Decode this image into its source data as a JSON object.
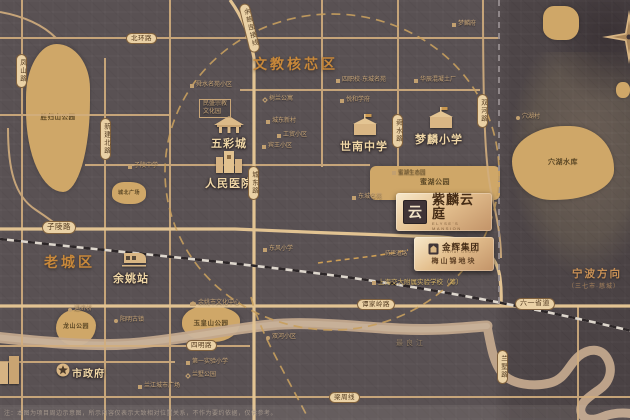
{
  "zones": {
    "edu_core": "文教核芯区",
    "old_town": "老城区",
    "ningbo_dir": "宁波方向",
    "ningbo_sub": "（三七市·慈城）"
  },
  "project": {
    "logo_glyph": "云",
    "name": "紫麟云庭",
    "name_en": "ELYSE'S MANSION",
    "developer": "金辉集团",
    "developer_en": "JINHUI GROUP",
    "plot": "梅山锦地块"
  },
  "colors": {
    "background": "#595153",
    "road": "#d2ae7e",
    "road_major": "#e2c392",
    "park": "#cfa768",
    "zone_title": "#c8883a",
    "poi_text": "#f0d7a6",
    "badge_gold": "#e4c08f",
    "river": "#c3a88d",
    "railway_dark": "#2c2628"
  },
  "disclaimer": "注：本图为项目周边示意图，所示内容仅表示大致相对位置关系，不作为要约依据，仅供参考。",
  "parks": [
    {
      "name": "shengguishan-park",
      "label": "胜归山公园",
      "x": 26,
      "y": 44,
      "w": 64,
      "h": 148,
      "r": "48% 52% 42% 58% / 36% 30% 62% 55%",
      "fs": 6.5
    },
    {
      "name": "north-plaza",
      "label": "城北广场",
      "x": 112,
      "y": 182,
      "w": 34,
      "h": 22,
      "r": "35% 45% 40% 45% / 45% 45% 40% 40%",
      "fs": 5
    },
    {
      "name": "longshan-park",
      "label": "龙山公园",
      "x": 56,
      "y": 310,
      "w": 40,
      "h": 36,
      "r": "45% 55% 50% 50% / 50% 42% 58% 50%",
      "fs": 6
    },
    {
      "name": "yuhuangshan-park",
      "label": "玉皇山公园",
      "x": 182,
      "y": 306,
      "w": 58,
      "h": 36,
      "r": "40% 50% 45% 55% / 45% 40% 55% 50%",
      "fs": 6.5
    },
    {
      "name": "mihu-park",
      "label": "蜜湖公园",
      "x": 370,
      "y": 166,
      "w": 130,
      "h": 34,
      "r": "6px",
      "fs": 7
    },
    {
      "name": "xuehu-reservoir",
      "label": "穴湖水库",
      "x": 512,
      "y": 126,
      "w": 102,
      "h": 74,
      "r": "55% 45% 60% 40% / 50% 60% 42% 55%",
      "fs": 7
    },
    {
      "name": "ne-green-block",
      "label": "",
      "x": 543,
      "y": 6,
      "w": 36,
      "h": 34,
      "r": "30% 40% 35% 40% / 35% 40% 40% 35%",
      "fs": 5
    },
    {
      "name": "ne-green-dot",
      "label": "",
      "x": 616,
      "y": 82,
      "w": 14,
      "h": 16,
      "r": "45%",
      "fs": 5
    }
  ],
  "pois": [
    {
      "name": "wucai-city",
      "label": "五彩城",
      "x": 211,
      "y": 135,
      "fs": 11,
      "icon": "pavilion",
      "ix": 211,
      "iy": 114
    },
    {
      "name": "peoples-hospital",
      "label": "人民医院",
      "x": 205,
      "y": 175,
      "fs": 11,
      "icon": "hospital",
      "ix": 215,
      "iy": 148
    },
    {
      "name": "shinan-middle-school",
      "label": "世南中学",
      "x": 340,
      "y": 138,
      "fs": 11,
      "icon": "school",
      "ix": 352,
      "iy": 114
    },
    {
      "name": "menglin-primary-school",
      "label": "梦麟小学",
      "x": 415,
      "y": 131,
      "fs": 11,
      "icon": "school",
      "ix": 428,
      "iy": 107
    },
    {
      "name": "yuyao-station",
      "label": "余姚站",
      "x": 113,
      "y": 270,
      "fs": 11,
      "icon": "train",
      "ix": 120,
      "iy": 252
    },
    {
      "name": "city-hall",
      "label": "市政府",
      "x": 72,
      "y": 365,
      "fs": 10,
      "icon": "star",
      "ix": 56,
      "iy": 363
    },
    {
      "name": "riverside-buildings",
      "label": "",
      "x": 0,
      "y": 0,
      "fs": 1,
      "icon": "buildings",
      "ix": 0,
      "iy": 356
    }
  ],
  "tiny_pois": [
    {
      "name": "kindergarten",
      "label": "舜水名苑小区",
      "x": 190,
      "y": 82,
      "icon": "sq"
    },
    {
      "name": "religion-culture-park",
      "label": "民盛宗教\n文化园",
      "x": 199,
      "y": 99,
      "boxed": true
    },
    {
      "name": "shulan-apartment",
      "label": "树兰公寓",
      "x": 263,
      "y": 96,
      "icon": "dia"
    },
    {
      "name": "chengdong-village",
      "label": "城东新村",
      "x": 266,
      "y": 118,
      "icon": "sq"
    },
    {
      "name": "gongmao-village",
      "label": "工贸小区",
      "x": 277,
      "y": 132,
      "icon": "sq"
    },
    {
      "name": "binwang-village",
      "label": "宾王小区",
      "x": 262,
      "y": 143,
      "icon": "sq"
    },
    {
      "name": "zhiling-school",
      "label": "子陵中学",
      "x": 128,
      "y": 163,
      "icon": "sq"
    },
    {
      "name": "menglin-mansion",
      "label": "梦麟府",
      "x": 452,
      "y": 21,
      "icon": "sq"
    },
    {
      "name": "concrete-plant",
      "label": "华辰混凝土厂",
      "x": 414,
      "y": 77,
      "icon": "sq"
    },
    {
      "name": "vocational-school",
      "label": "四职校·东城名苑",
      "x": 336,
      "y": 77,
      "icon": "sq"
    },
    {
      "name": "yuehe-estate",
      "label": "悦和学府",
      "x": 340,
      "y": 97,
      "icon": "sq"
    },
    {
      "name": "mihu-eco",
      "label": "蜜湖生态园",
      "x": 392,
      "y": 170,
      "icon": "sq",
      "color": "#6a5430",
      "fs": 5.5
    },
    {
      "name": "dongcheng-estate",
      "label": "东城名苑",
      "x": 352,
      "y": 194,
      "icon": "sq"
    },
    {
      "name": "xuehu-village",
      "label": "穴湖村",
      "x": 516,
      "y": 114,
      "icon": "dot"
    },
    {
      "name": "tongji-bridge",
      "label": "通济桥",
      "x": 68,
      "y": 306,
      "icon": "dot"
    },
    {
      "name": "yangming-old-town",
      "label": "阳明古镇",
      "x": 114,
      "y": 317,
      "icon": "dot"
    },
    {
      "name": "culture-center",
      "label": "余姚市文化中心",
      "x": 190,
      "y": 300,
      "icon": "bank"
    },
    {
      "name": "dongfeng-school",
      "label": "东风小学",
      "x": 263,
      "y": 246,
      "icon": "sq"
    },
    {
      "name": "shuanghe-village",
      "label": "双河小区",
      "x": 266,
      "y": 334,
      "icon": "dot"
    },
    {
      "name": "first-exp-school",
      "label": "第一实验小学",
      "x": 186,
      "y": 359,
      "icon": "sq"
    },
    {
      "name": "lanshu-park",
      "label": "兰墅公园",
      "x": 186,
      "y": 372,
      "icon": "dia"
    },
    {
      "name": "lanjiang-plaza",
      "label": "兰江城市广场",
      "x": 138,
      "y": 383,
      "icon": "sq"
    },
    {
      "name": "jiaotong-school",
      "label": "上海交大附属实验学校（筹）",
      "x": 372,
      "y": 279,
      "icon": "sq",
      "color": "#d8b668",
      "fs": 6.5
    },
    {
      "name": "planned-road",
      "label": "待建道路",
      "x": 385,
      "y": 251,
      "fs": 5.5
    },
    {
      "name": "zuiliang-river",
      "label": "最良江",
      "x": 396,
      "y": 340,
      "color": "#937e64",
      "fs": 7,
      "ls": 3
    }
  ],
  "road_pills": [
    {
      "name": "beihuan-road",
      "label": "北环路",
      "x": 126,
      "y": 33
    },
    {
      "name": "ziling-road",
      "label": "子陵路",
      "x": 42,
      "y": 221,
      "fs": 7.5
    },
    {
      "name": "tanjialing-road",
      "label": "谭家岭路",
      "x": 357,
      "y": 299
    },
    {
      "name": "liuyi-highway",
      "label": "六一省道",
      "x": 515,
      "y": 298,
      "fs": 7
    },
    {
      "name": "siming-road",
      "label": "四明路",
      "x": 186,
      "y": 340
    },
    {
      "name": "liangzhou-line",
      "label": "梁周线",
      "x": 329,
      "y": 392
    },
    {
      "name": "fengshan-road",
      "label": "凤山路",
      "x": 16,
      "y": 54,
      "v": true
    },
    {
      "name": "xinjian-north-road",
      "label": "新建北路",
      "x": 100,
      "y": 118,
      "v": true
    },
    {
      "name": "chengdong-road",
      "label": "城东路",
      "x": 248,
      "y": 166,
      "v": true
    },
    {
      "name": "shunshui-road",
      "label": "舜水路",
      "x": 392,
      "y": 114,
      "v": true
    },
    {
      "name": "shuanghe-road",
      "label": "双河路",
      "x": 477,
      "y": 94,
      "v": true
    },
    {
      "name": "lanshu-road",
      "label": "兰墅路",
      "x": 497,
      "y": 350,
      "v": true
    },
    {
      "name": "yuci-connection-line",
      "label": "余慈连接线",
      "x": 244,
      "y": 3,
      "v": true,
      "rot": -14
    }
  ]
}
